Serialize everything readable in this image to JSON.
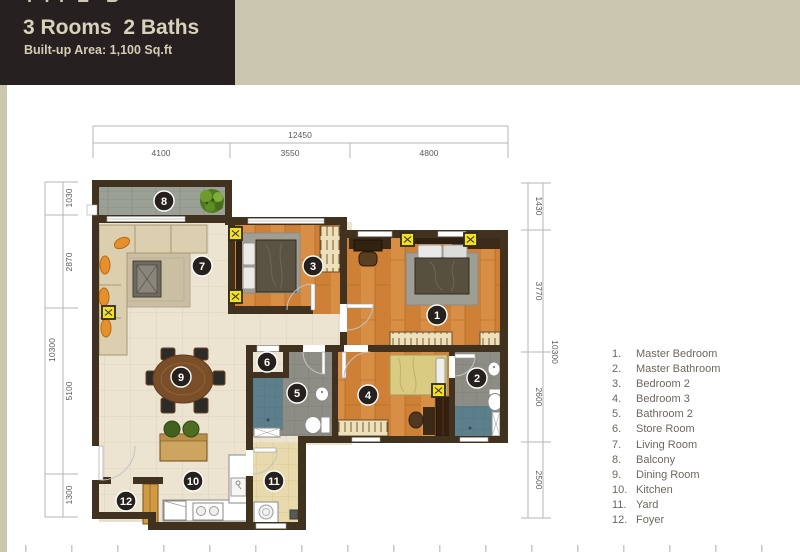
{
  "header": {
    "type_label": "TYPE B",
    "title": "3 Rooms  2 Baths",
    "subtitle": "Built-up Area: 1,100 Sq.ft"
  },
  "legend": {
    "items": [
      {
        "num": "1.",
        "label": "Master Bedroom"
      },
      {
        "num": "2.",
        "label": "Master Bathroom"
      },
      {
        "num": "3.",
        "label": "Bedroom 2"
      },
      {
        "num": "4.",
        "label": "Bedroom 3"
      },
      {
        "num": "5.",
        "label": "Bathroom 2"
      },
      {
        "num": "6.",
        "label": "Store Room"
      },
      {
        "num": "7.",
        "label": "Living Room"
      },
      {
        "num": "8.",
        "label": "Balcony"
      },
      {
        "num": "9.",
        "label": "Dining Room"
      },
      {
        "num": "10.",
        "label": "Kitchen"
      },
      {
        "num": "11.",
        "label": "Yard"
      },
      {
        "num": "12.",
        "label": "Foyer"
      }
    ]
  },
  "dimensions": {
    "top": {
      "total": "12450",
      "segments": [
        "4100",
        "3550",
        "4800"
      ]
    },
    "left": {
      "total": "10300",
      "segments": [
        "1030",
        "2870",
        "5100",
        "1300"
      ]
    },
    "right": {
      "total": "10300",
      "segments": [
        "1430",
        "3770",
        "2600",
        "2500"
      ]
    }
  },
  "plan": {
    "rooms": [
      "1",
      "2",
      "3",
      "4",
      "5",
      "6",
      "7",
      "8",
      "9",
      "10",
      "11",
      "12"
    ]
  },
  "colors": {
    "page_bg": "#cbc7af",
    "header_bg": "#262120",
    "header_text": "#d8d1bb",
    "legend_text": "#6e6760",
    "wall": "#41311f",
    "wood_floor": "#ce8136",
    "cream_tile": "#ece4d1",
    "balcony_tile": "#9ba096",
    "bath_tile": "#8d8d85",
    "shower_teal": "#5d7f8b",
    "yard_tile": "#e8daad",
    "light_yellow": "#f4e01c",
    "badge": "#27211d"
  }
}
